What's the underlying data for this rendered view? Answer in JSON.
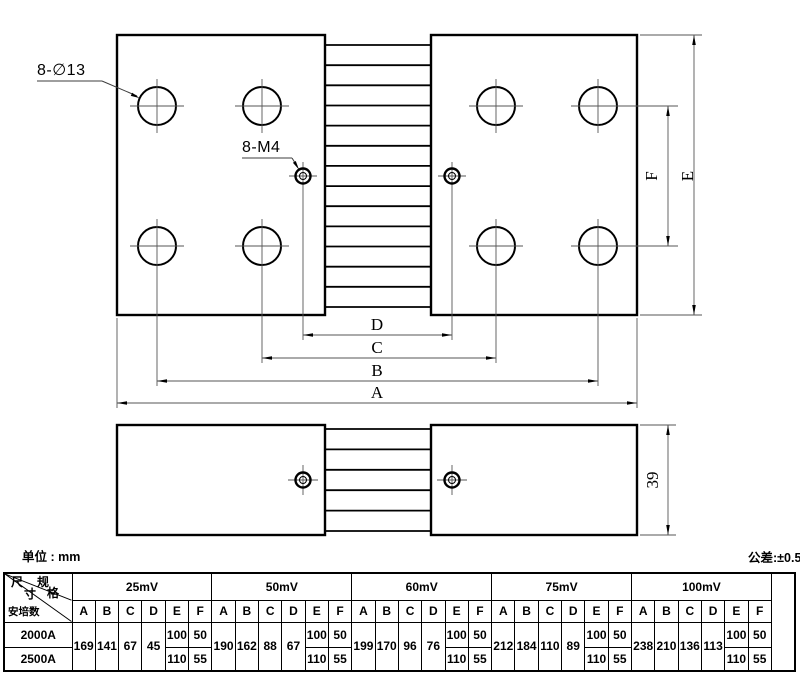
{
  "meta": {
    "unit_label": "单位 : mm",
    "tolerance_label": "公差:±0.5"
  },
  "drawing": {
    "callouts": {
      "large_holes": "8-∅13",
      "small_holes": "8-M4"
    },
    "dims": {
      "A": "A",
      "B": "B",
      "C": "C",
      "D": "D",
      "E": "E",
      "F": "F",
      "thickness": "39"
    }
  },
  "table": {
    "corner": {
      "dim_char_1": "尺",
      "dim_char_2": "寸",
      "spec_char_1": "规",
      "spec_char_2": "格",
      "amperage_label": "安培数"
    },
    "col_headers": [
      "A",
      "B",
      "C",
      "D",
      "E",
      "F"
    ],
    "row_labels": [
      "2000A",
      "2500A"
    ],
    "groups": [
      {
        "label": "25mV",
        "A": "169",
        "B": "141",
        "C": "67",
        "D": "45",
        "E": [
          "100",
          "110"
        ],
        "F": [
          "50",
          "55"
        ]
      },
      {
        "label": "50mV",
        "A": "190",
        "B": "162",
        "C": "88",
        "D": "67",
        "E": [
          "100",
          "110"
        ],
        "F": [
          "50",
          "55"
        ]
      },
      {
        "label": "60mV",
        "A": "199",
        "B": "170",
        "C": "96",
        "D": "76",
        "E": [
          "100",
          "110"
        ],
        "F": [
          "50",
          "55"
        ]
      },
      {
        "label": "75mV",
        "A": "212",
        "B": "184",
        "C": "110",
        "D": "89",
        "E": [
          "100",
          "110"
        ],
        "F": [
          "50",
          "55"
        ]
      },
      {
        "label": "100mV",
        "A": "238",
        "B": "210",
        "C": "136",
        "D": "113",
        "E": [
          "100",
          "110"
        ],
        "F": [
          "50",
          "55"
        ]
      }
    ]
  }
}
